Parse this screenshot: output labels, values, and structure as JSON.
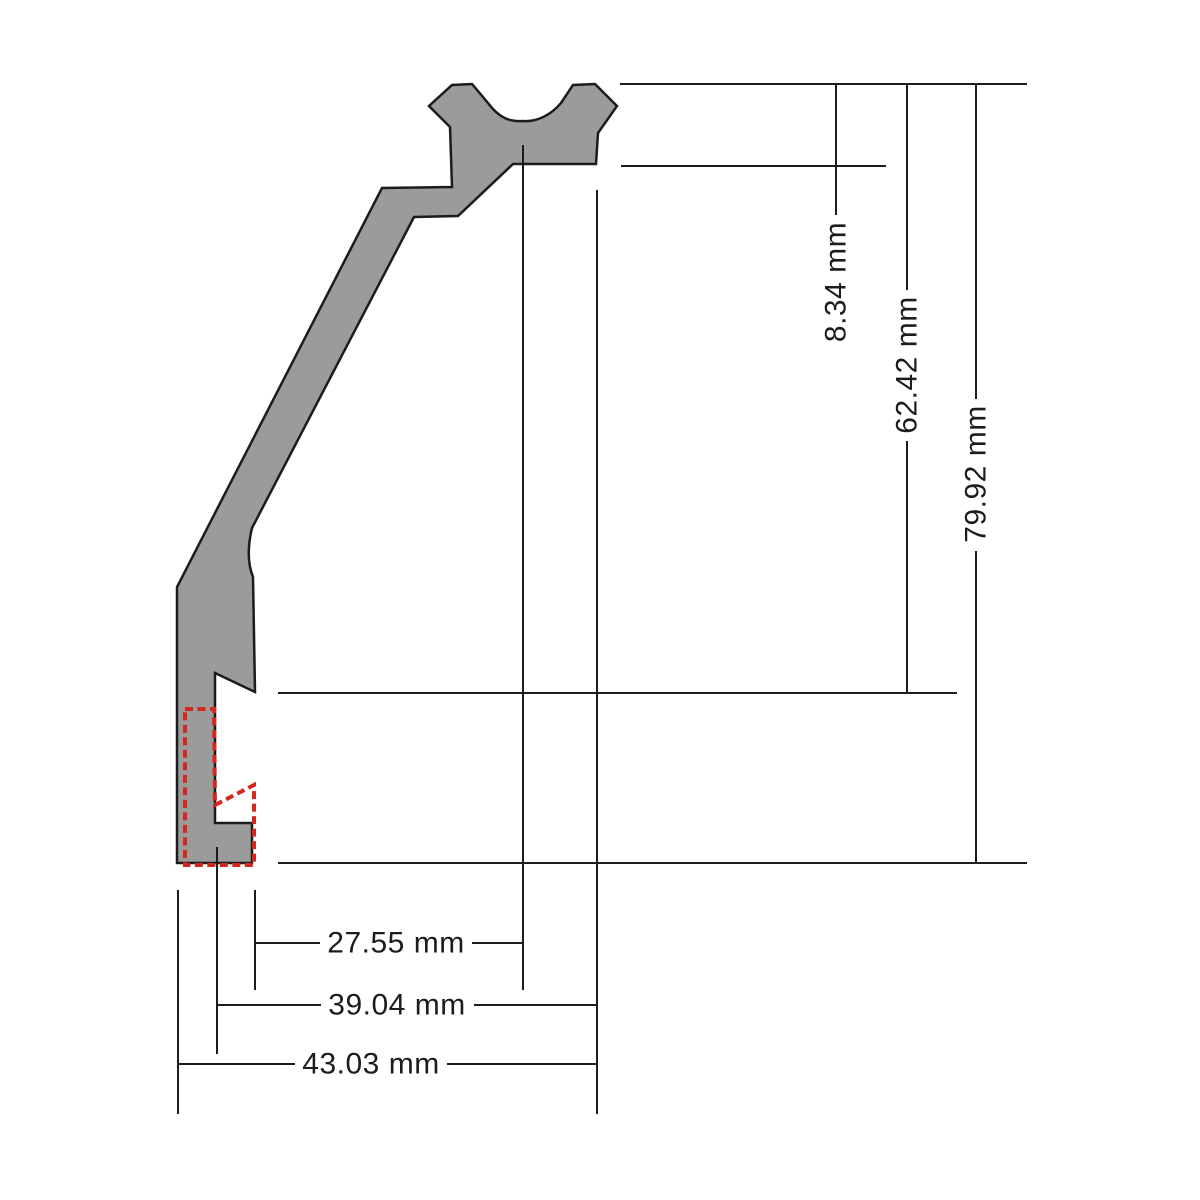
{
  "diagram": {
    "kind": "cross-section-technical-drawing",
    "unit": "mm",
    "colors": {
      "profile_fill": "#9b9b9b",
      "outline": "#1c1c1c",
      "dimension_line": "#1c1c1c",
      "highlight": "#d2281e",
      "background": "#ffffff"
    },
    "vertical_dimensions": [
      {
        "label": "8.34 mm",
        "value": 8.34
      },
      {
        "label": "62.42 mm",
        "value": 62.42
      },
      {
        "label": "79.92 mm",
        "value": 79.92
      }
    ],
    "horizontal_dimensions": [
      {
        "label": "27.55 mm",
        "value": 27.55
      },
      {
        "label": "39.04 mm",
        "value": 39.04
      },
      {
        "label": "43.03 mm",
        "value": 43.03
      }
    ]
  }
}
